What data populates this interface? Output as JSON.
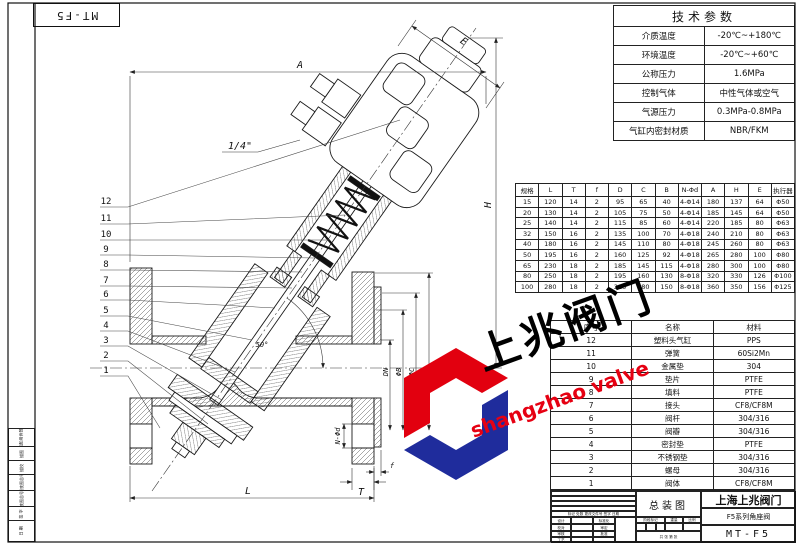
{
  "sheet": {
    "corner_code": "MT-F5"
  },
  "tech_params": {
    "title": "技术参数",
    "rows": [
      {
        "label": "介质温度",
        "value": "-20℃~+180℃"
      },
      {
        "label": "环境温度",
        "value": "-20℃~+60℃"
      },
      {
        "label": "公称压力",
        "value": "1.6MPa"
      },
      {
        "label": "控制气体",
        "value": "中性气体或空气"
      },
      {
        "label": "气源压力",
        "value": "0.3MPa-0.8MPa"
      },
      {
        "label": "气缸内密封材质",
        "value": "NBR/FKM"
      }
    ]
  },
  "dimensions_table": {
    "headers": [
      "规格",
      "L",
      "T",
      "f",
      "D",
      "C",
      "B",
      "N-Φd",
      "A",
      "H",
      "E",
      "执行器"
    ],
    "rows": [
      [
        "15",
        "120",
        "14",
        "2",
        "95",
        "65",
        "40",
        "4-Φ14",
        "180",
        "137",
        "64",
        "Φ50"
      ],
      [
        "20",
        "130",
        "14",
        "2",
        "105",
        "75",
        "50",
        "4-Φ14",
        "185",
        "145",
        "64",
        "Φ50"
      ],
      [
        "25",
        "140",
        "14",
        "2",
        "115",
        "85",
        "60",
        "4-Φ14",
        "220",
        "185",
        "80",
        "Φ63"
      ],
      [
        "32",
        "150",
        "16",
        "2",
        "135",
        "100",
        "70",
        "4-Φ18",
        "240",
        "210",
        "80",
        "Φ63"
      ],
      [
        "40",
        "180",
        "16",
        "2",
        "145",
        "110",
        "80",
        "4-Φ18",
        "245",
        "260",
        "80",
        "Φ63"
      ],
      [
        "50",
        "195",
        "16",
        "2",
        "160",
        "125",
        "92",
        "4-Φ18",
        "265",
        "280",
        "100",
        "Φ80"
      ],
      [
        "65",
        "230",
        "18",
        "2",
        "185",
        "145",
        "115",
        "4-Φ18",
        "280",
        "300",
        "100",
        "Φ80"
      ],
      [
        "80",
        "250",
        "18",
        "2",
        "195",
        "160",
        "130",
        "8-Φ18",
        "320",
        "330",
        "126",
        "Φ100"
      ],
      [
        "100",
        "280",
        "18",
        "2",
        "215",
        "180",
        "150",
        "8-Φ18",
        "360",
        "350",
        "156",
        "Φ125"
      ]
    ]
  },
  "parts_table": {
    "headers": [
      "序号",
      "名称",
      "材料"
    ],
    "rows": [
      [
        "12",
        "塑料头气缸",
        "PPS"
      ],
      [
        "11",
        "弹簧",
        "60Si2Mn"
      ],
      [
        "10",
        "金属垫",
        "304"
      ],
      [
        "9",
        "垫片",
        "PTFE"
      ],
      [
        "8",
        "填料",
        "PTFE"
      ],
      [
        "7",
        "接头",
        "CF8/CF8M"
      ],
      [
        "6",
        "阀杆",
        "304/316"
      ],
      [
        "5",
        "阀瓣",
        "304/316"
      ],
      [
        "4",
        "密封垫",
        "PTFE"
      ],
      [
        "3",
        "不锈钢垫",
        "304/316"
      ],
      [
        "2",
        "螺母",
        "304/316"
      ],
      [
        "1",
        "阀体",
        "CF8/CF8M"
      ]
    ]
  },
  "title_block": {
    "assembly": "总装图",
    "company": "上海上兆阀门",
    "product": "F5系列角座阀",
    "code": "MT-F5",
    "rev_header": "标记 处数 更改文件号 签字 日期",
    "sign_rows": [
      "设计",
      "校对",
      "审核",
      "工艺"
    ],
    "sign_rows2": [
      "标准化",
      "审定",
      "批准",
      ""
    ],
    "stage": "阶段标记",
    "weight": "重量",
    "scale": "比例",
    "sheet_info": "共 张  第 张"
  },
  "left_strip": {
    "labels": [
      "借(通)用件登记",
      "描图",
      "描校",
      "旧底图总号",
      "底图总号",
      "签 字",
      "日 期"
    ]
  },
  "watermark": {
    "cn": "上兆阀门",
    "en": "shangzhao valve",
    "red": "#e60012",
    "blue": "#1f2c9c"
  },
  "drawing": {
    "balloons": [
      "12",
      "11",
      "10",
      "9",
      "8",
      "7",
      "6",
      "5",
      "4",
      "3",
      "2",
      "1"
    ],
    "labels": {
      "A": "A",
      "E": "E",
      "H": "H",
      "L": "L",
      "T": "T",
      "f": "f",
      "DN": "DN",
      "phiB": "ΦB",
      "phiC": "ΦC",
      "phiD": "ΦD",
      "nphid": "N-Φd",
      "port": "1/4\"",
      "angle": "50°"
    }
  }
}
